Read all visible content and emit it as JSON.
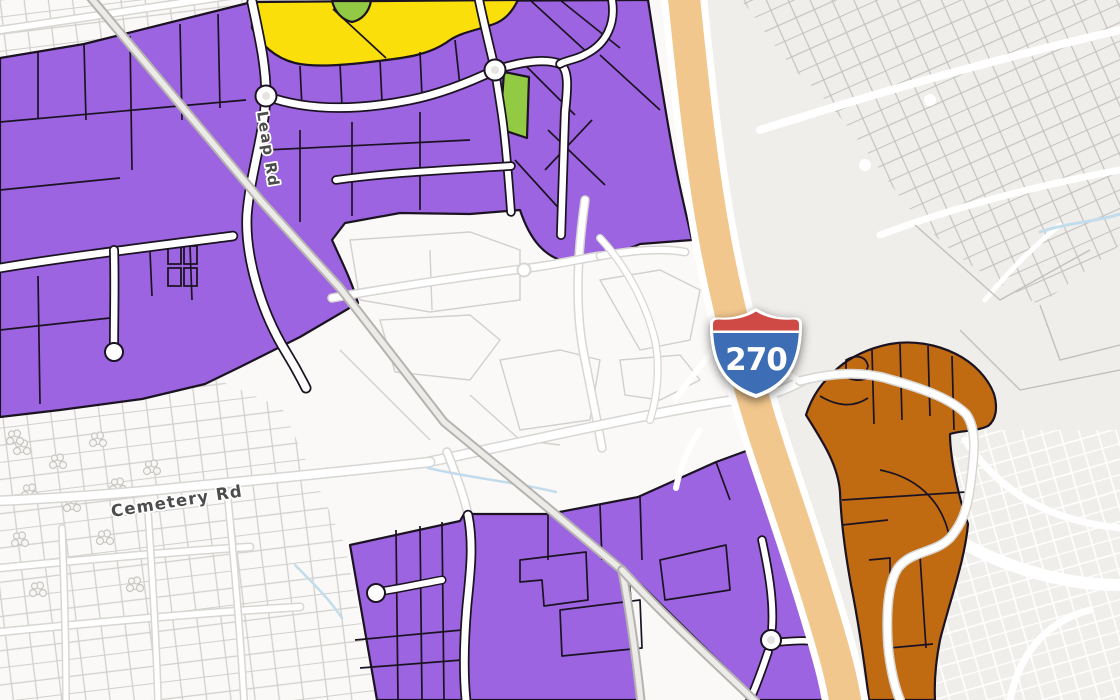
{
  "map": {
    "description": "Zoning parcel map near an Interstate 270 interchange",
    "road_labels": {
      "leap": "Leap Rd",
      "cemetery": "Cemetery Rd"
    },
    "highway_shield": {
      "system": "Interstate",
      "number": "270"
    },
    "zone_colors": {
      "purple": "#9c64e0",
      "yellow": "#fbdf0a",
      "green": "#92cb43",
      "orange": "#c06a12",
      "zoneOutline": "#1b1322"
    },
    "base_colors": {
      "bgLeft": "#faf9f7",
      "bgRight": "#f0eeeb",
      "parcelGray": "#d2d0cd",
      "parcelGrayDark": "#c2c0bd",
      "roadWhite": "#ffffff",
      "roadCasing": "#d8d6d3",
      "railCasing": "#b5b3b0",
      "railFill": "#edebe8",
      "highway": "#f2c78d",
      "label": "#4c4c4c",
      "shieldBlue": "#3d6db5",
      "shieldRed": "#cf4a44",
      "water": "#c3dcec"
    }
  }
}
